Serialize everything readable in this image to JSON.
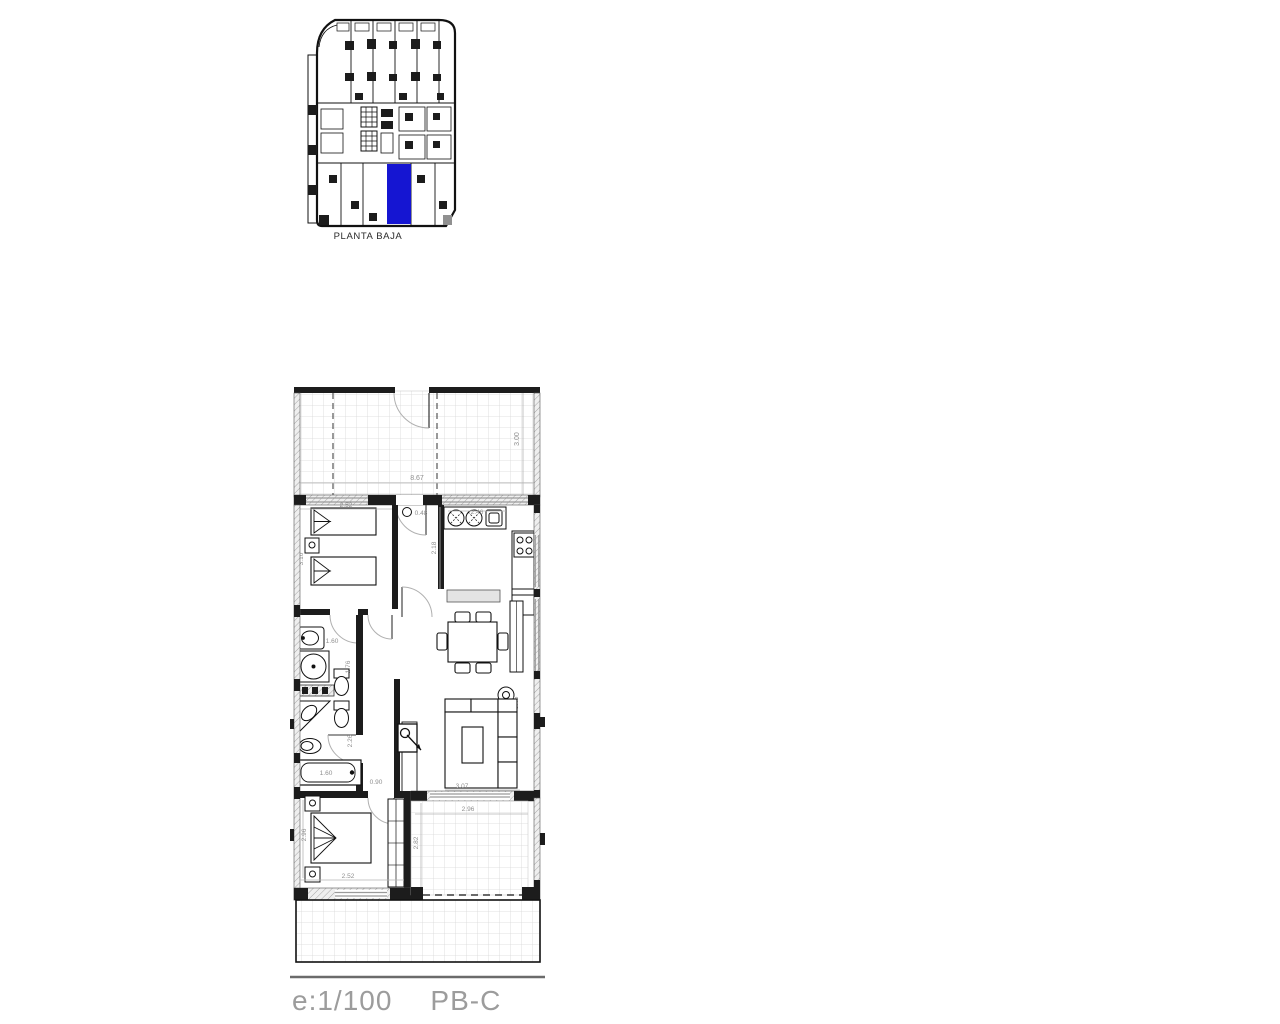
{
  "page": {
    "background": "#ffffff"
  },
  "overview": {
    "label": "PLANTA BAJA",
    "highlight_color": "#1515d2"
  },
  "plan": {
    "scale_label": "e:1/100",
    "unit_label": "PB-C",
    "dims": {
      "terrace_width": "8.67",
      "terrace_depth": "3.00",
      "bedroom1_width": "2.52",
      "bedroom1_depth": "3.10",
      "entry": "0.48",
      "kitchen_width": "2.46",
      "kitchen_depth": "2.18",
      "bath1_width": "1.60",
      "bath1_depth": "1.76",
      "bath2_depth": "2.26",
      "bathtub": "1.60",
      "corridor_width": "0.90",
      "living_width": "3.07",
      "side_table": "0.45",
      "bedroom2_width": "2.52",
      "bedroom2_depth": "2.96",
      "terrace2_width": "2.96",
      "terrace2_depth": "2.82"
    }
  },
  "colors": {
    "wall": "#1c1c1c",
    "dimension_text": "#8f8f8f",
    "scale_text": "#9c9c9c"
  }
}
